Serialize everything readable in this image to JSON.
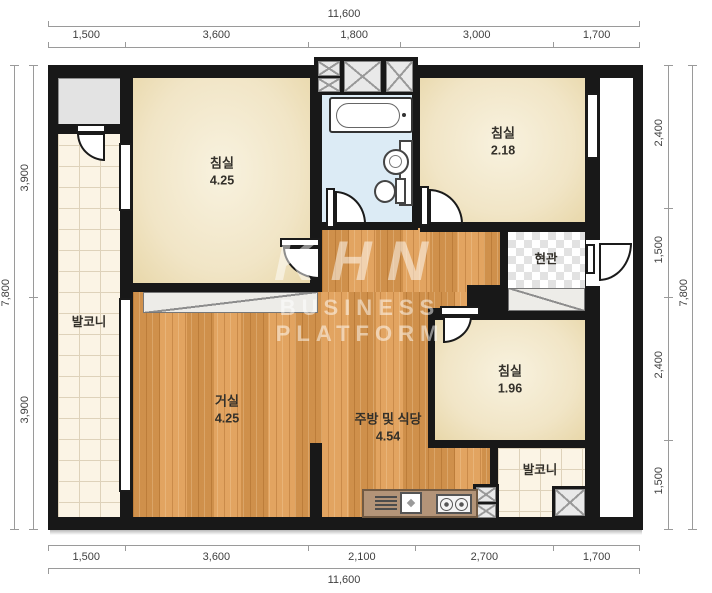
{
  "plan": {
    "watermark": {
      "logo": "KHN",
      "subtitle": "BUSINESS PLATFORM"
    },
    "rooms": {
      "bedroom1": {
        "name": "침실",
        "area": "4.25"
      },
      "bedroom2": {
        "name": "침실",
        "area": "2.18"
      },
      "bedroom3": {
        "name": "침실",
        "area": "1.96"
      },
      "living": {
        "name": "거실",
        "area": "4.25"
      },
      "kitchen": {
        "name": "주방 및 식당",
        "area": "4.54"
      },
      "entrance": {
        "name": "현관"
      },
      "balcony_left": {
        "name": "발코니"
      },
      "balcony_right": {
        "name": "발코니"
      }
    },
    "dimensions": {
      "top": {
        "total": "11,600",
        "segments": [
          "1,500",
          "3,600",
          "1,800",
          "3,000",
          "1,700"
        ]
      },
      "bottom": {
        "total": "11,600",
        "segments": [
          "1,500",
          "3,600",
          "2,100",
          "2,700",
          "1,700"
        ]
      },
      "left": {
        "total": "7,800",
        "segments": [
          "3,900",
          "3,900"
        ]
      },
      "right": {
        "total": "7,800",
        "segments": [
          "2,400",
          "1,500",
          "2,400",
          "1,500"
        ]
      }
    },
    "colors": {
      "wall": "#181818",
      "wood_floor": "#df9b51",
      "tile_floor": "#fbf4e5",
      "bath_floor": "#dcebf5",
      "bedroom_floor": "#f1e5c6",
      "dim_line": "#9a9a9a"
    }
  }
}
